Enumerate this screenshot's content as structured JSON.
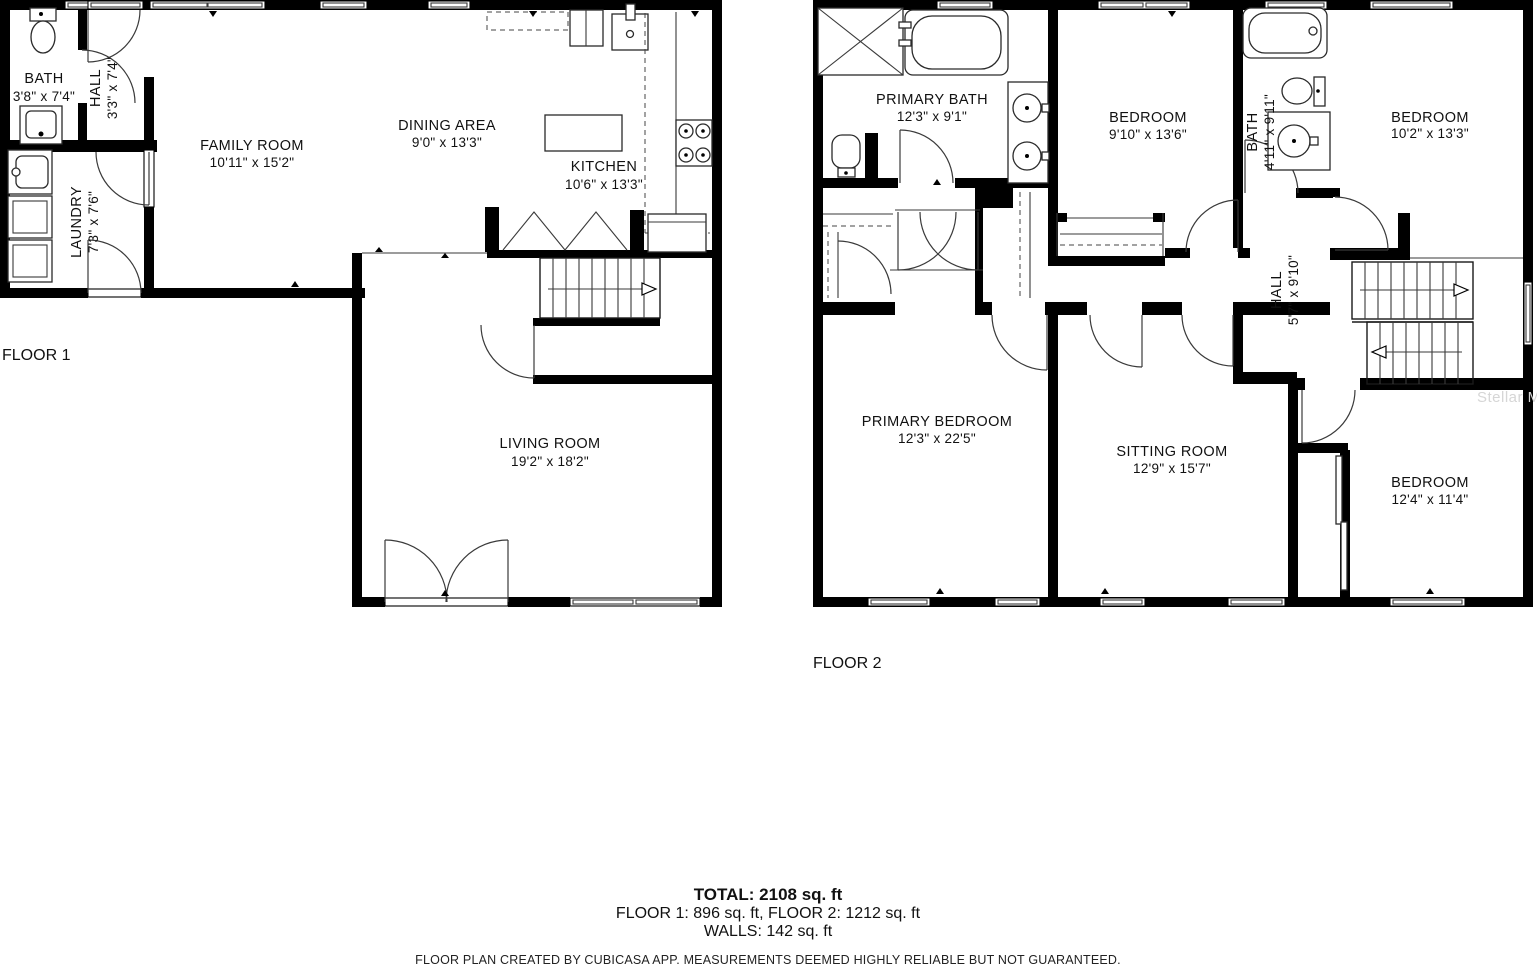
{
  "floor1": {
    "label": "FLOOR 1",
    "rooms": {
      "bath": {
        "name": "BATH",
        "dims": "3'8\" x 7'4\""
      },
      "hall": {
        "name": "HALL",
        "dims": "3'3\" x 7'4\""
      },
      "laundry": {
        "name": "LAUNDRY",
        "dims": "7'3\" x 7'6\""
      },
      "family": {
        "name": "FAMILY ROOM",
        "dims": "10'11\" x 15'2\""
      },
      "dining": {
        "name": "DINING AREA",
        "dims": "9'0\" x 13'3\""
      },
      "kitchen": {
        "name": "KITCHEN",
        "dims": "10'6\" x 13'3\""
      },
      "living": {
        "name": "LIVING ROOM",
        "dims": "19'2\" x 18'2\""
      }
    }
  },
  "floor2": {
    "label": "FLOOR 2",
    "rooms": {
      "primary_bath": {
        "name": "PRIMARY BATH",
        "dims": "12'3\" x 9'1\""
      },
      "bedroom_mid": {
        "name": "BEDROOM",
        "dims": "9'10\" x 13'6\""
      },
      "bath": {
        "name": "BATH",
        "dims": "4'11\" x 9'11\""
      },
      "bedroom_right": {
        "name": "BEDROOM",
        "dims": "10'2\" x 13'3\""
      },
      "hall": {
        "name": "HALL",
        "dims": "5'7\" x 9'10\""
      },
      "primary_bedroom": {
        "name": "PRIMARY BEDROOM",
        "dims": "12'3\" x 22'5\""
      },
      "sitting": {
        "name": "SITTING ROOM",
        "dims": "12'9\" x 15'7\""
      },
      "bedroom_bottom": {
        "name": "BEDROOM",
        "dims": "12'4\" x 11'4\""
      }
    }
  },
  "summary": {
    "total": "TOTAL: 2108 sq. ft",
    "floors": "FLOOR 1: 896 sq. ft, FLOOR 2: 1212 sq. ft",
    "walls": "WALLS: 142 sq. ft"
  },
  "disclaimer": "FLOOR PLAN CREATED BY CUBICASA APP. MEASUREMENTS DEEMED HIGHLY RELIABLE BUT NOT GUARANTEED.",
  "watermark": "Stellar M"
}
